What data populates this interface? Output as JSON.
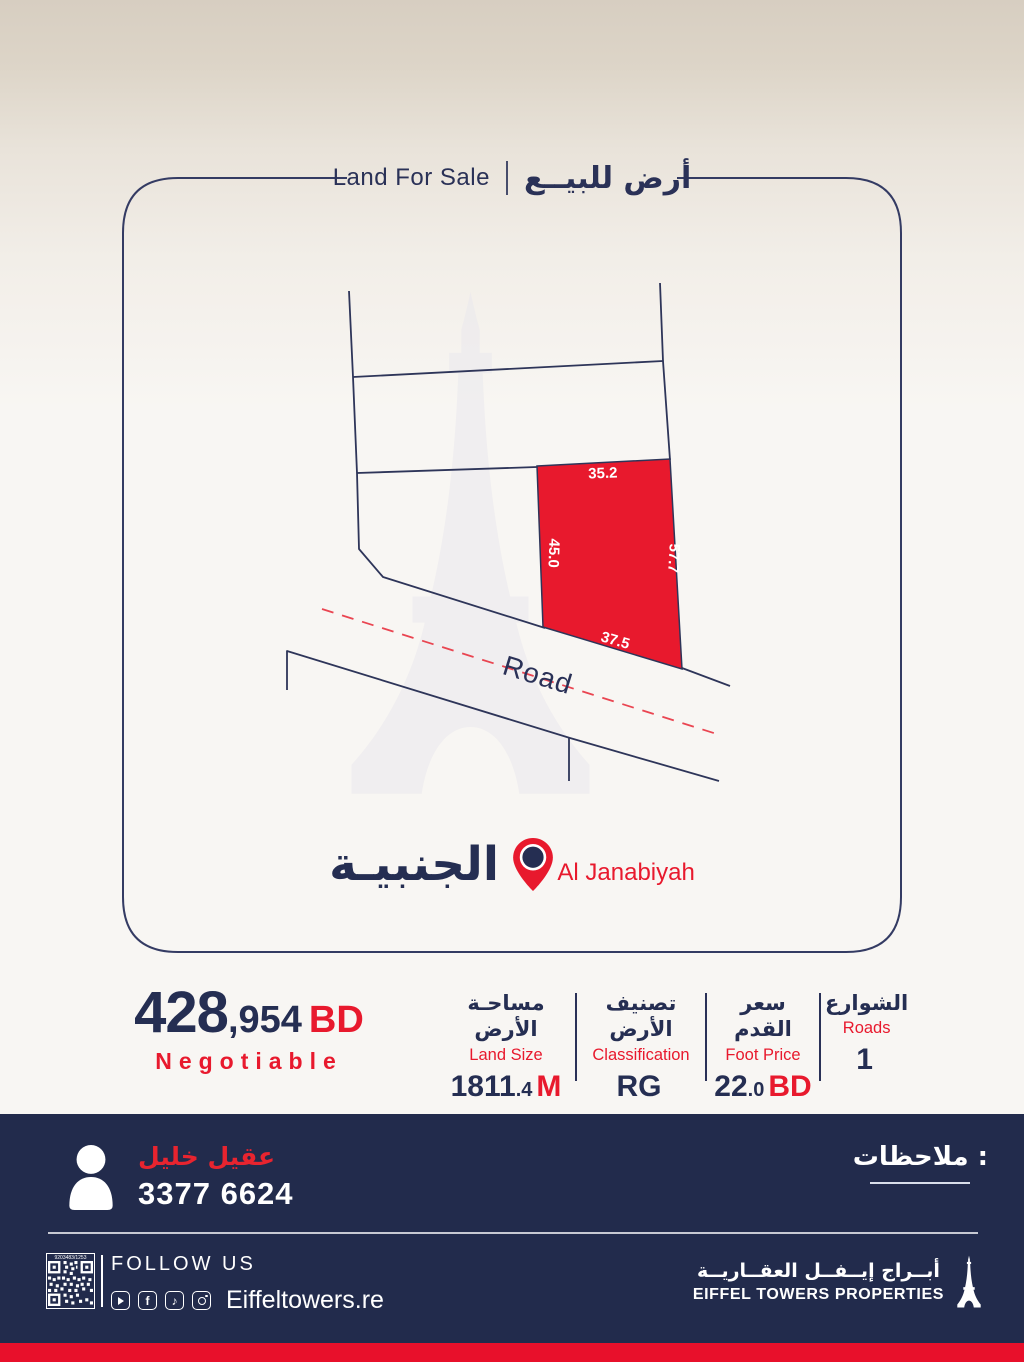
{
  "header": {
    "title_en": "Land For Sale",
    "title_ar": "أرض للبيــع"
  },
  "map": {
    "road_label": "Road",
    "dim_top": "35.2",
    "dim_left": "45.0",
    "dim_right": "57.7",
    "dim_bottom": "37.5"
  },
  "location": {
    "name_ar": "الجنبيـة",
    "name_en": "Al Janabiyah"
  },
  "price": {
    "main": "428",
    "rest": ",954",
    "currency": "BD",
    "note": "Negotiable"
  },
  "details": {
    "columns": [
      {
        "ar": "مساحـة الأرض",
        "en": "Land Size",
        "value_main": "1811",
        "value_small": ".4",
        "value_unit": "M"
      },
      {
        "ar": "تصنيف الأرض",
        "en": "Classification",
        "value_main": "RG",
        "value_small": "",
        "value_unit": ""
      },
      {
        "ar": "سعر القدم",
        "en": "Foot Price",
        "value_main": "22",
        "value_small": ".0",
        "value_unit": "BD"
      },
      {
        "ar": "الشوارع",
        "en": "Roads",
        "value_main": "1",
        "value_small": "",
        "value_unit": ""
      }
    ]
  },
  "contact": {
    "name_ar": "عقيل خليل",
    "phone": "3377 6624",
    "notes_label": "ملاحظات :"
  },
  "footer": {
    "qr_caption": "9203483/1253",
    "follow_us": "FOLLOW US",
    "website": "Eiffeltowers.re",
    "logo_ar": "أبــراج إيــفــل العقــاريــة",
    "logo_en": "EIFFEL TOWERS PROPERTIES"
  },
  "colors": {
    "navy": "#2a3157",
    "footer_navy": "#222b4c",
    "red": "#e8192d"
  }
}
